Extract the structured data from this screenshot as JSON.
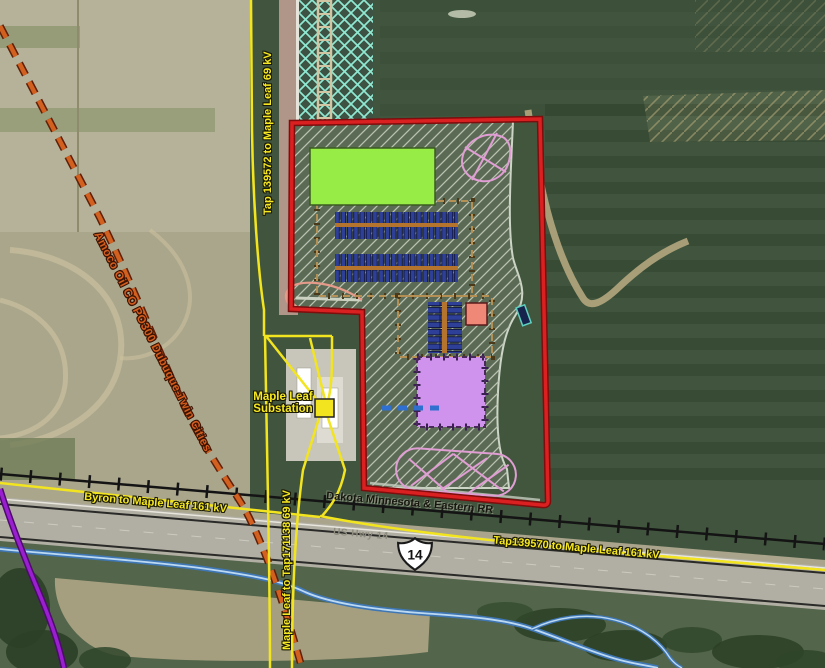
{
  "title": "Maple Leaf Substation site aerial map",
  "labels": {
    "tap_139572_69kv": "Tap 139572 to Maple Leaf 69 kV",
    "pipeline_amoco": "Amoco Oil CO PO300 Dubuque-Twin Cities",
    "substation_name_line1": "Maple Leaf",
    "substation_name_line2": "Substation",
    "byron_161kv": "Byron to Maple Leaf 161 kV",
    "maple_leaf_tap171138_69kv": "Maple Leaf to Tap171138 69 kV",
    "railroad": "Dakota Minnesota & Eastern RR",
    "us_hwy": "US Hwy 14",
    "us_hwy_shield": "14",
    "tap139570_161kv": "Tap139570 to Maple Leaf 161 kV"
  },
  "features": {
    "site_boundary_color": "#da2020",
    "transmission_line_color": "#f2e41f",
    "railroad_color": "#111111",
    "pipeline_color": "#d2601f",
    "purple_line_color": "#9a1fd0",
    "stream_color": "#5d9bd3",
    "proposed_building_color": "#97ed45",
    "equipment_row_color": "#2e3f98",
    "substation_pad_color": "#cf93ee",
    "laydown_area_color": "#e09ed4",
    "control_enclosure_color": "#f08878",
    "existing_corridor_color": "#8fe8d2",
    "substation_symbol_color": "#f2e41f"
  }
}
